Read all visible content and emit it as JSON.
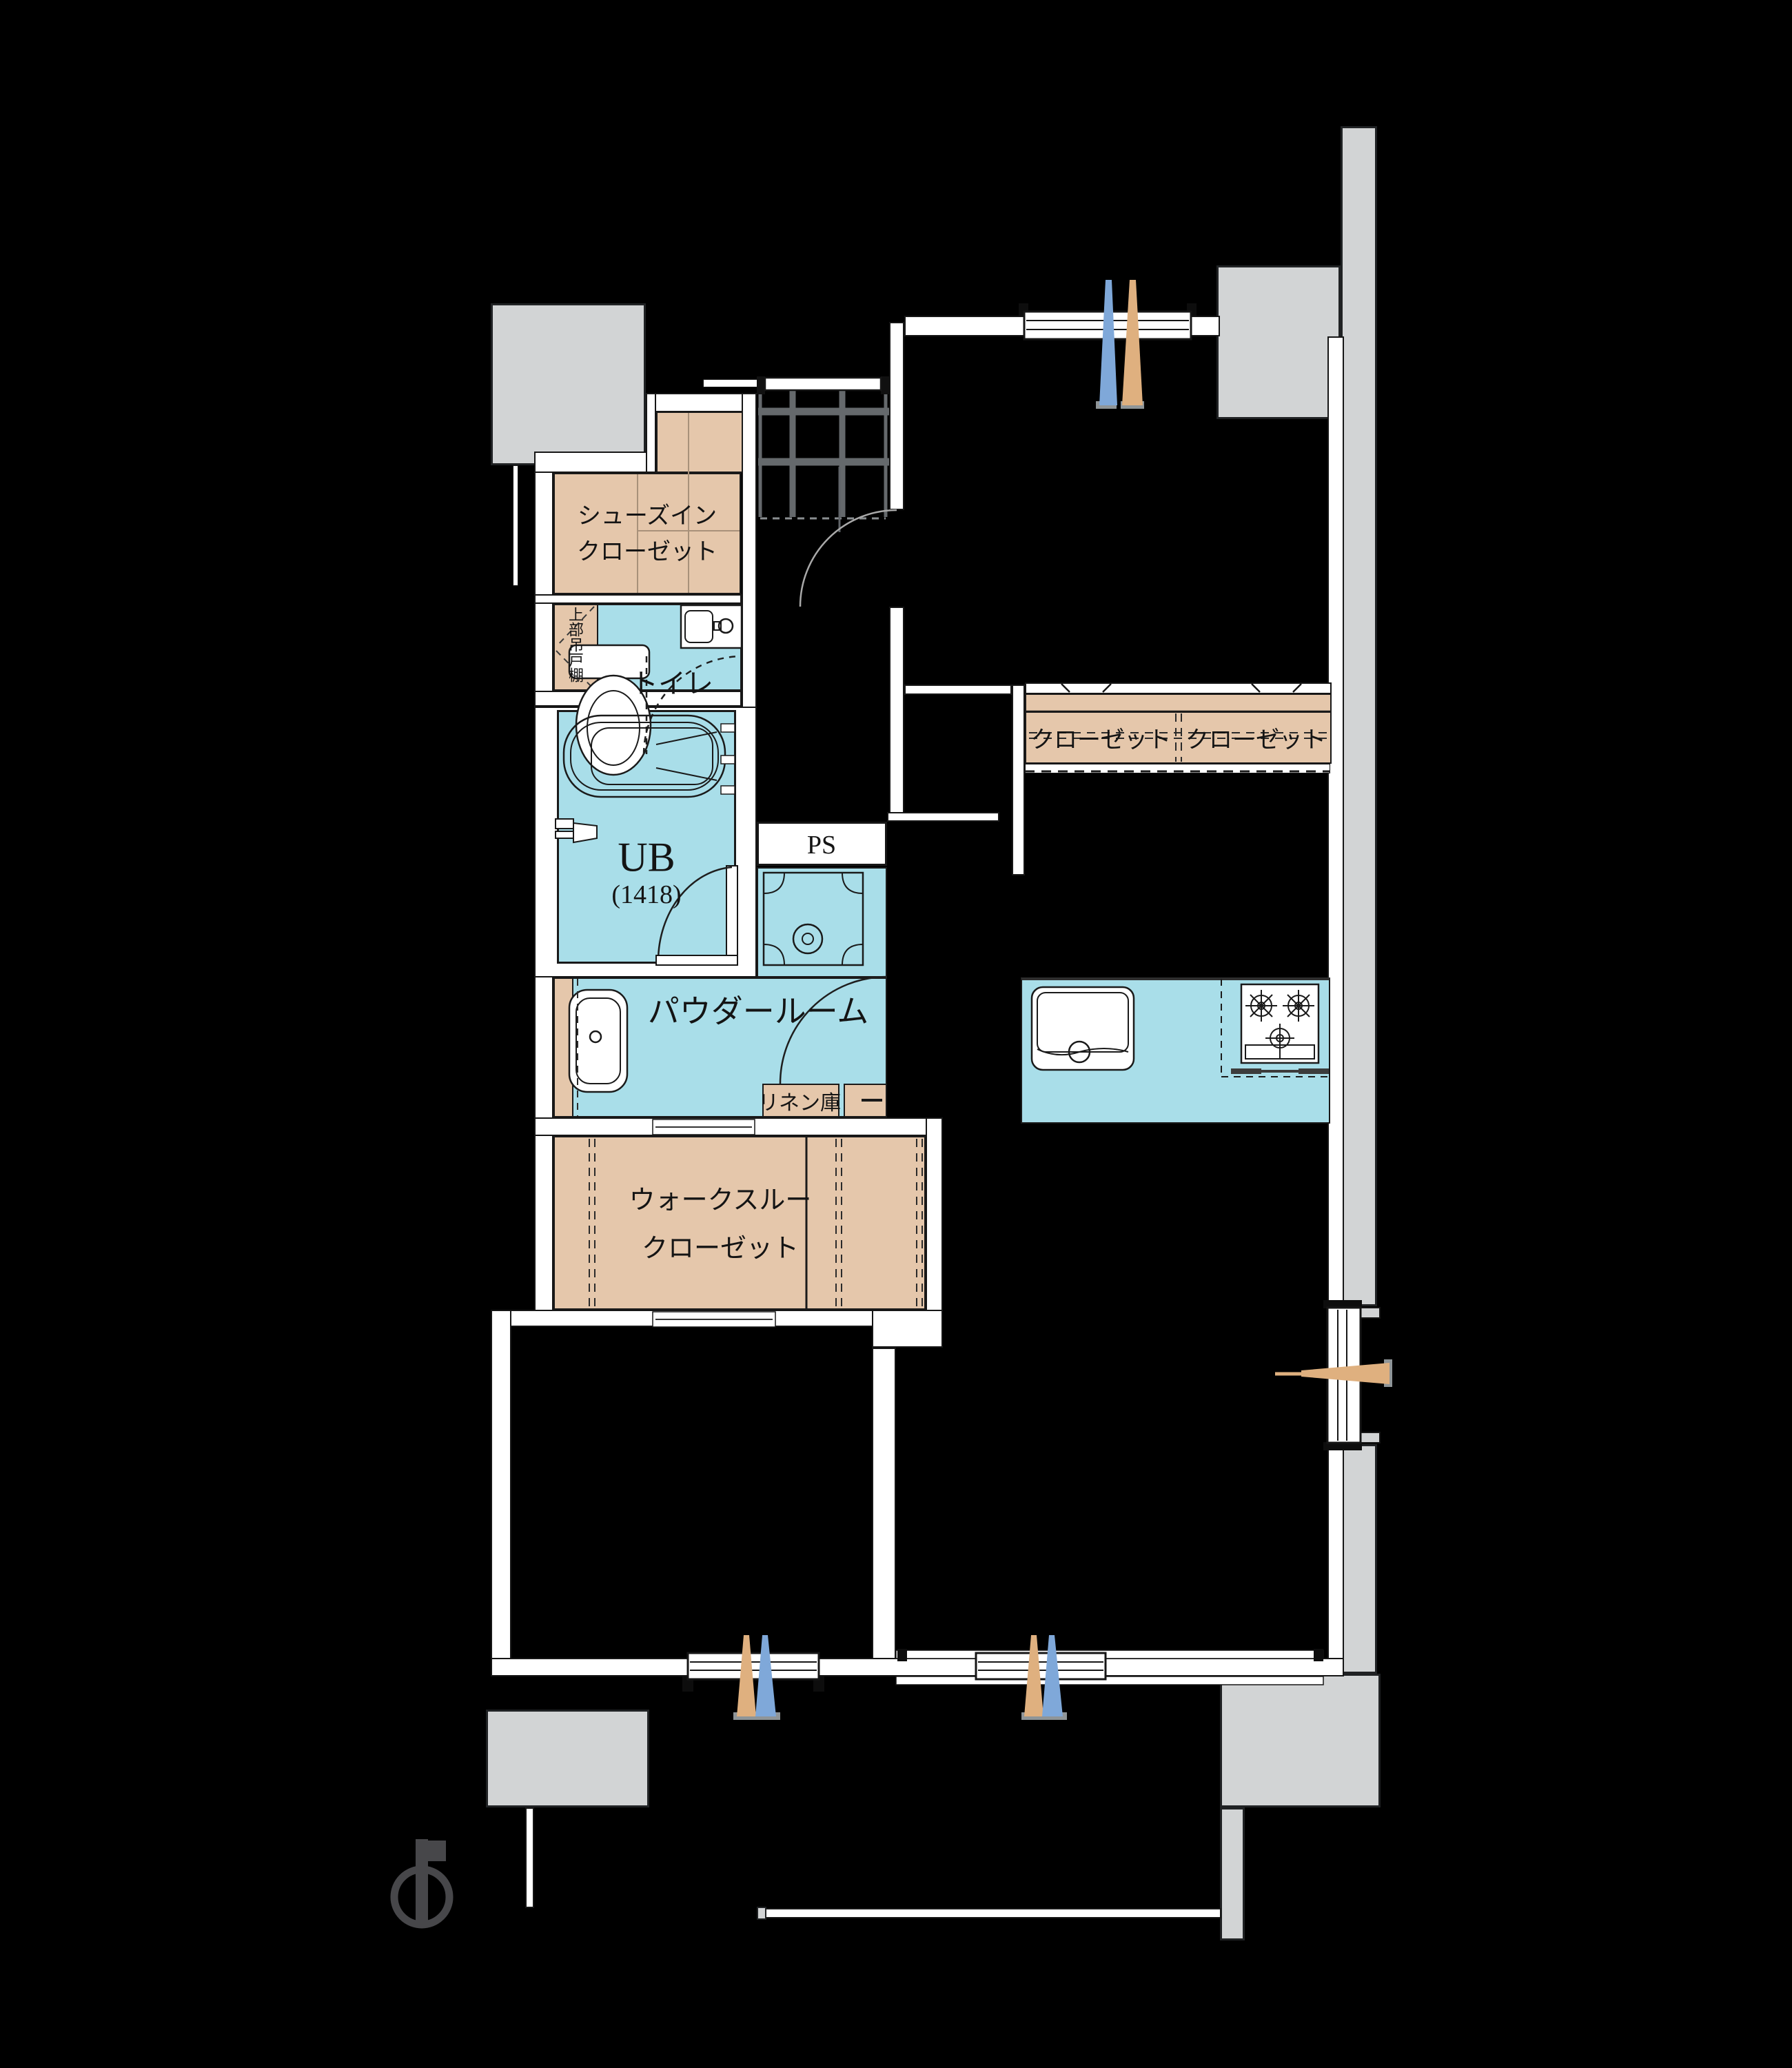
{
  "plan": {
    "type": "apartment-floorplan",
    "rooms": {
      "shoes_in_closet": {
        "label_line1": "シューズイン",
        "label_line2": "クローゼット"
      },
      "upper_hanging_shelf": {
        "label": "上部吊戸棚"
      },
      "toilet": {
        "label": "トイレ"
      },
      "unit_bath": {
        "label": "UB",
        "size": "(1418)"
      },
      "pipe_space": {
        "label": "PS"
      },
      "powder_room": {
        "label": "パウダールーム"
      },
      "linen_storage": {
        "label": "リネン庫"
      },
      "walk_through_closet": {
        "label_line1": "ウォークスルー",
        "label_line2": "クローゼット"
      },
      "closet_left": {
        "label": "クローゼット"
      },
      "closet_right": {
        "label": "クローゼット"
      }
    },
    "colors": {
      "background": "#000000",
      "wall": "#ffffff",
      "concrete_balcony": "#d2d4d5",
      "water_area": "#a9dee9",
      "storage_area": "#e5c7ab",
      "vent_arrow_blue": "#7fa8d9",
      "vent_arrow_tan": "#dfb07f",
      "entrance_tile_line": "#65696c",
      "text": "#141414"
    }
  }
}
